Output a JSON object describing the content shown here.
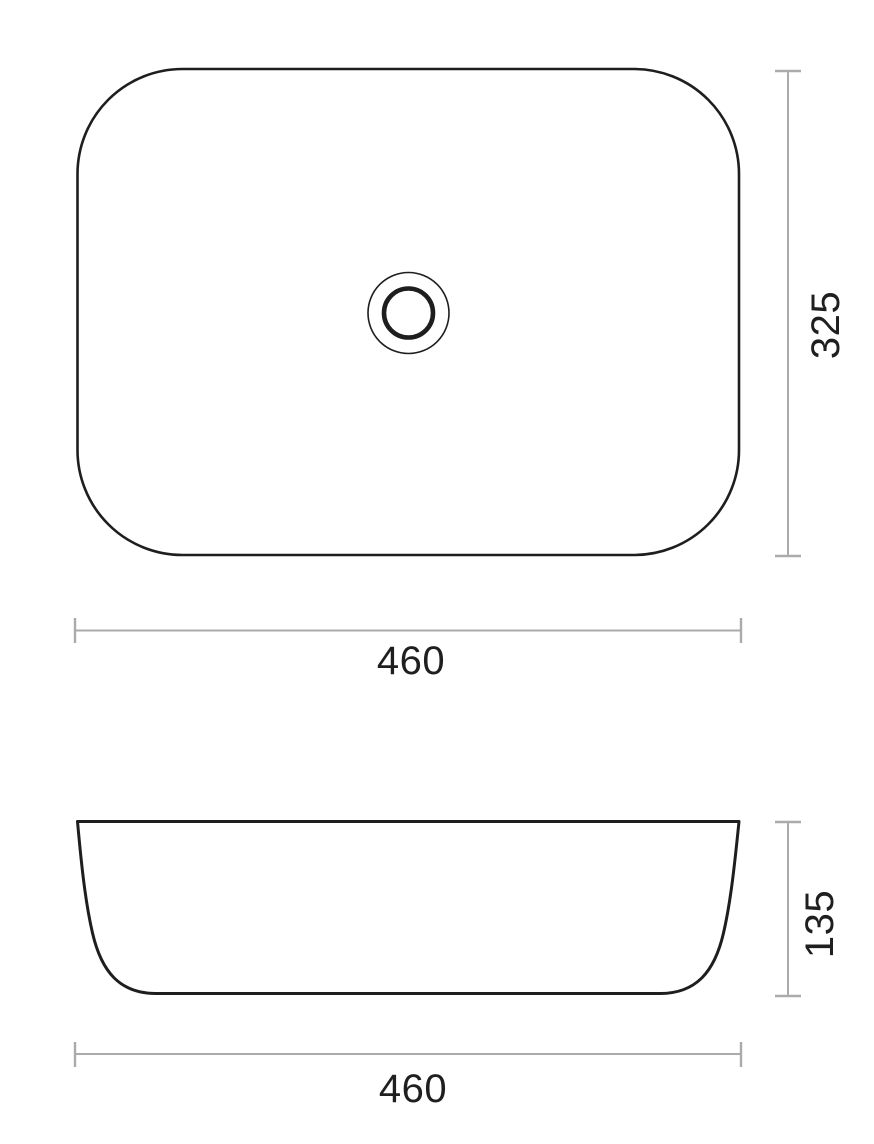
{
  "colors": {
    "background": "#ffffff",
    "outline": "#1e1e1e",
    "dim_line": "#ababab",
    "dim_text": "#1f1f1f"
  },
  "drawing": {
    "plan_view": {
      "depth_label": "325",
      "width_label": "460"
    },
    "elevation_view": {
      "height_label": "135",
      "width_label": "460"
    }
  }
}
